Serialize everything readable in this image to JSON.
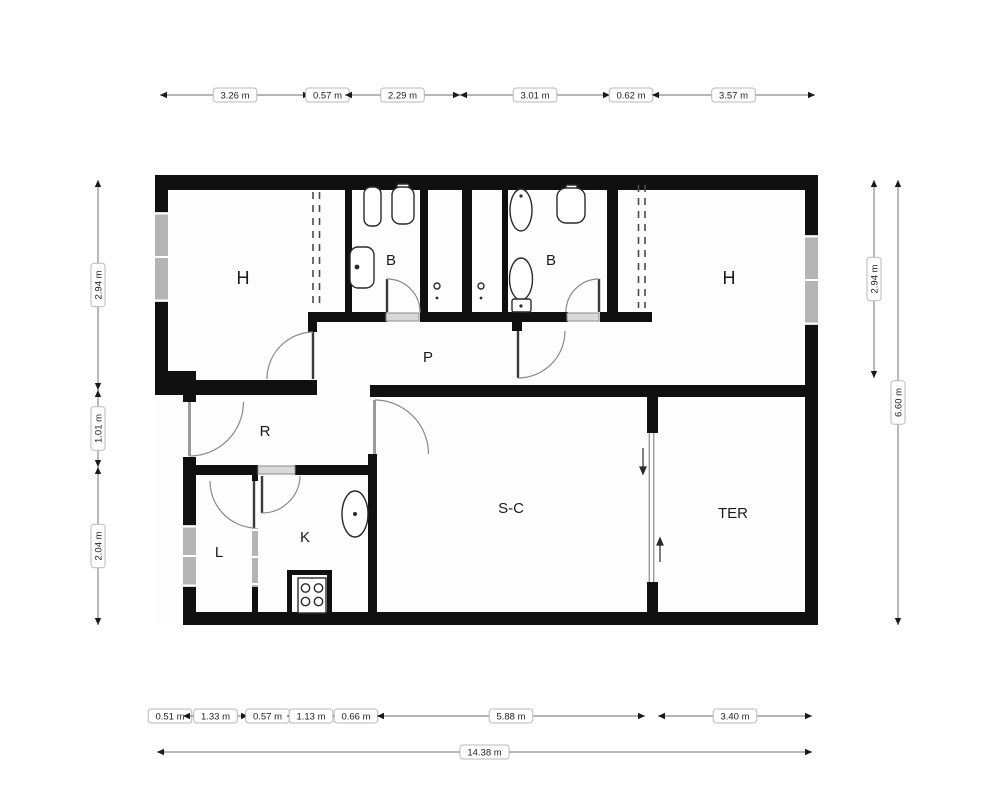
{
  "page": {
    "background": "#ffffff",
    "type": "architectural floor plan"
  },
  "colors": {
    "wall": "#101010",
    "dim_line": "#8a8a8a",
    "arrow": "#1a1a1a",
    "label_box_fill": "#ffffff",
    "label_box_border": "#b9b9b9",
    "label_text": "#222222",
    "window": "#b4b4b4"
  },
  "icons": [
    "toilet-icon",
    "bidet-icon",
    "washbasin-icon",
    "bathtub-sink-icon",
    "kitchen-sink-icon",
    "stove-burners-icon",
    "duct-vent-icon",
    "door-swing-arc-icon",
    "sliding-door-arrow-icon",
    "wardrobe-dashed-icon"
  ],
  "floorplan": {
    "rooms": [
      {
        "id": "bedroom-left",
        "label": "H",
        "x": 243,
        "y": 284,
        "size": 18
      },
      {
        "id": "bathroom-left",
        "label": "B",
        "x": 391,
        "y": 265,
        "size": 15
      },
      {
        "id": "bathroom-right",
        "label": "B",
        "x": 551,
        "y": 265,
        "size": 15
      },
      {
        "id": "bedroom-right",
        "label": "H",
        "x": 729,
        "y": 284,
        "size": 18
      },
      {
        "id": "hallway",
        "label": "P",
        "x": 428,
        "y": 362,
        "size": 15
      },
      {
        "id": "entry-hall",
        "label": "R",
        "x": 265,
        "y": 436,
        "size": 15
      },
      {
        "id": "laundry",
        "label": "L",
        "x": 219,
        "y": 557,
        "size": 15
      },
      {
        "id": "kitchen",
        "label": "K",
        "x": 305,
        "y": 542,
        "size": 15
      },
      {
        "id": "living-dining",
        "label": "S-C",
        "x": 511,
        "y": 513,
        "size": 15
      },
      {
        "id": "terrace",
        "label": "TER",
        "x": 733,
        "y": 518,
        "size": 15
      }
    ],
    "dimensions": {
      "rows": [
        {
          "id": "top",
          "orient": "h",
          "pos": 95,
          "segments": [
            {
              "from": 160,
              "to": 310,
              "label": "3.26 m"
            },
            {
              "from": 310,
              "to": 345,
              "label": "0.57 m"
            },
            {
              "from": 345,
              "to": 460,
              "label": "2.29 m"
            },
            {
              "from": 460,
              "to": 610,
              "label": "3.01 m"
            },
            {
              "from": 610,
              "to": 652,
              "label": "0.62 m"
            },
            {
              "from": 652,
              "to": 815,
              "label": "3.57 m"
            }
          ]
        },
        {
          "id": "bottom-detail",
          "orient": "h",
          "pos": 716,
          "segments": [
            {
              "from": 157,
              "to": 183,
              "label": "0.51 m"
            },
            {
              "from": 183,
              "to": 248,
              "label": "1.33 m"
            },
            {
              "from": 248,
              "to": 287,
              "label": "0.57 m"
            },
            {
              "from": 287,
              "to": 335,
              "label": "1.13 m"
            },
            {
              "from": 335,
              "to": 377,
              "label": "0.66 m"
            },
            {
              "from": 377,
              "to": 645,
              "label": "5.88 m"
            },
            {
              "from": 658,
              "to": 812,
              "label": "3.40 m"
            }
          ]
        },
        {
          "id": "bottom-total",
          "orient": "h",
          "pos": 752,
          "segments": [
            {
              "from": 157,
              "to": 812,
              "label": "14.38 m"
            }
          ]
        },
        {
          "id": "left",
          "orient": "v",
          "pos": 98,
          "segments": [
            {
              "from": 180,
              "to": 390,
              "label": "2.94 m"
            },
            {
              "from": 390,
              "to": 467,
              "label": "1.01 m"
            },
            {
              "from": 467,
              "to": 625,
              "label": "2.04 m"
            }
          ]
        },
        {
          "id": "right-inner",
          "orient": "v",
          "pos": 874,
          "segments": [
            {
              "from": 180,
              "to": 378,
              "label": "2.94 m"
            }
          ]
        },
        {
          "id": "right-outer",
          "orient": "v",
          "pos": 898,
          "segments": [
            {
              "from": 180,
              "to": 625,
              "label": "6.60 m"
            }
          ]
        }
      ]
    }
  }
}
